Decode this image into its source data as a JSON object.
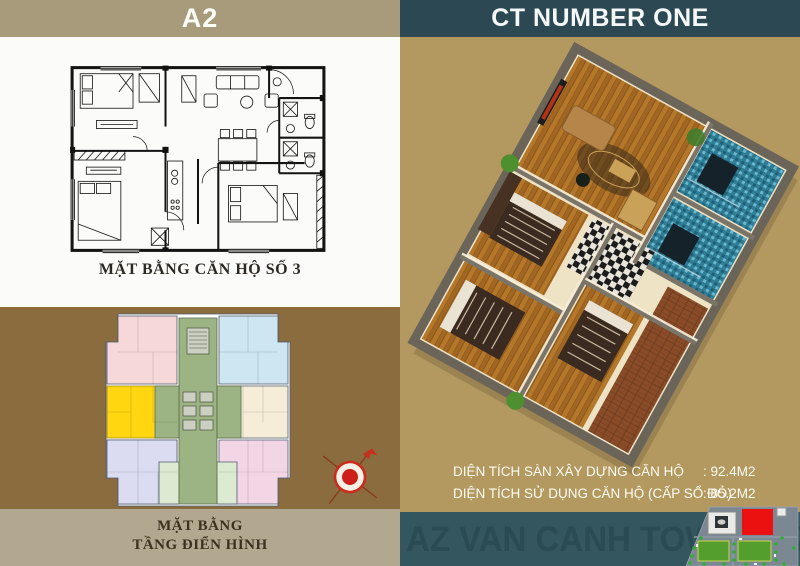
{
  "left_panel": {
    "header_title": "A2",
    "unit_plan_caption": "MẶT BẰNG  CĂN HỘ SỐ 3",
    "typical_floor_caption_line1": "MẶT BẰNG",
    "typical_floor_caption_line2": "TẦNG ĐIỂN HÌNH"
  },
  "right_panel": {
    "header_title": "CT NUMBER ONE",
    "area_rows": [
      {
        "label": "DIỆN TÍCH SÀN XÂY DỰNG CĂN HỘ",
        "value": ": 92.4M2"
      },
      {
        "label": "DIỆN TÍCH SỬ DỤNG CĂN HỘ (CẤP SỔ ĐỎ)",
        "value": ": 85.2M2"
      }
    ],
    "banner_watermark": "AZ VAN CANH TOWER AZ VAN CA"
  },
  "icons": {
    "compass": "compass-rose-north-indicator",
    "site_map": "project-site-map-thumbnail"
  },
  "colors": {
    "left_header_bg": "#a89b7c",
    "right_header_bg": "#2c4953",
    "left_brown_bg": "#8a6c3f",
    "left_strip_bg": "#b2a890",
    "right_gold_bg": "#b3985f",
    "banner_bg": "#33565f",
    "watermark_text": "#2a4a54",
    "highlight_unit_yellow": "#ffd60f",
    "core_green": "#9cb483",
    "site_red_building": "#ec1111",
    "site_park_green": "#549e2e"
  }
}
